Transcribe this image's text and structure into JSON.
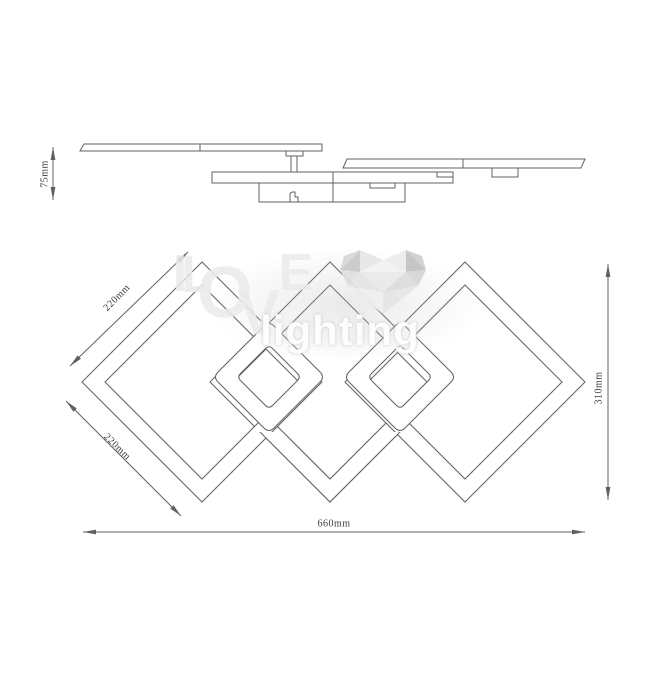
{
  "drawing": {
    "side_view": {
      "height_dimension": "75mm"
    },
    "plan_view": {
      "upper_left_edge_dimension": "220mm",
      "lower_left_edge_dimension": "220mm",
      "right_diagonal_dimension": "310mm",
      "overall_width_dimension": "660mm"
    },
    "colors": {
      "line": "#606060",
      "dim_text": "#3a3a3a"
    }
  },
  "watermark": {
    "brand_letters": [
      "I",
      "L",
      "O",
      "V",
      "E"
    ],
    "brand_word": "lighting",
    "heart_icon": "low-poly-heart",
    "letter_color": "#ebebeb",
    "word_color": "#ffffff"
  }
}
